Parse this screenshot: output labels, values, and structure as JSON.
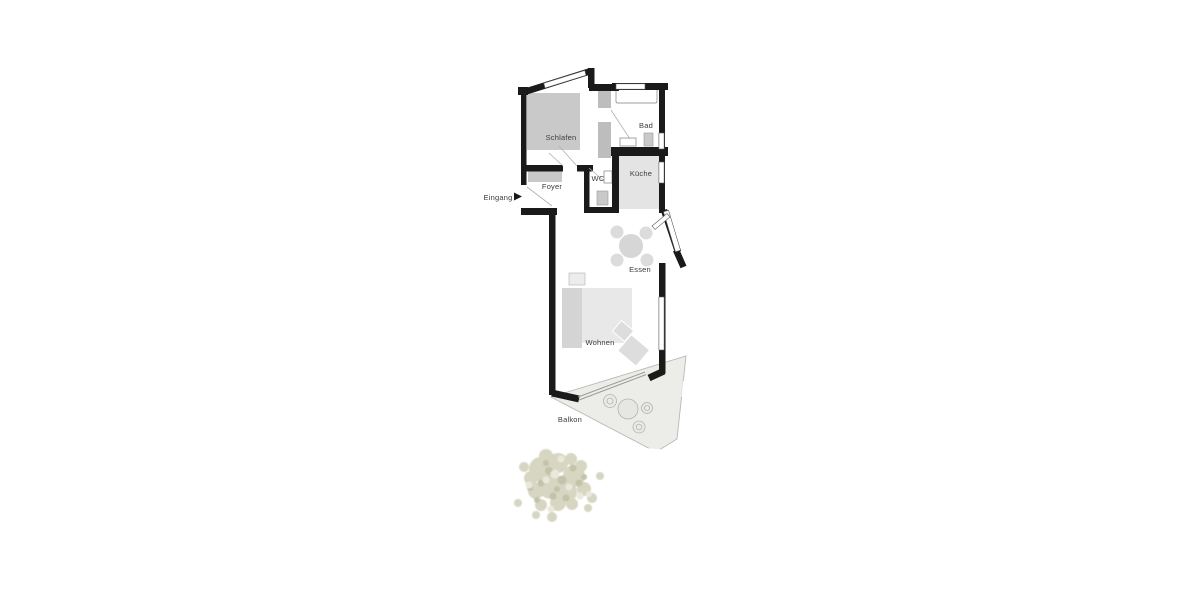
{
  "plan": {
    "type": "apartment-floor-plan",
    "labels": {
      "schlafen": "Schlafen",
      "bad": "Bad",
      "foyer": "Foyer",
      "wc": "WC",
      "kueche": "Küche",
      "essen": "Essen",
      "wohnen": "Wohnen",
      "balkon": "Balkon",
      "eingang": "Eingang"
    },
    "colors": {
      "wall": "#1a1a1a",
      "light_wall": "#bdbdbd",
      "furniture": "#c9c9c9",
      "floor_shade": "#e4e4e4",
      "balcony": "#ecece8",
      "tree": "#d7d7c3",
      "label_text": "#3c3c3c",
      "background": "#ffffff"
    }
  }
}
